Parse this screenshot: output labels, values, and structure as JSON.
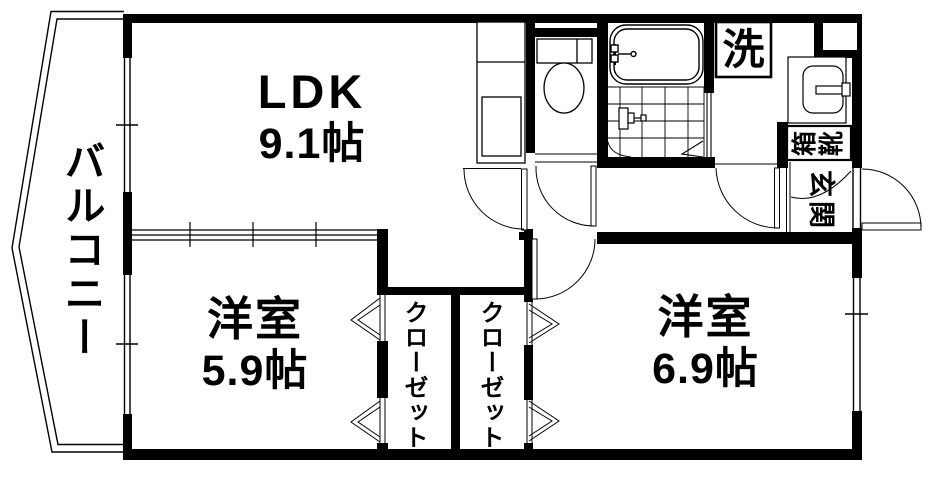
{
  "rooms": {
    "balcony": {
      "label": "バルコニー"
    },
    "ldk": {
      "label": "LDK",
      "size": "9.1帖"
    },
    "western_room_small": {
      "label": "洋室",
      "size": "5.9帖"
    },
    "western_room_large": {
      "label": "洋室",
      "size": "6.9帖"
    },
    "closet_left": {
      "label": "クローゼット"
    },
    "closet_right": {
      "label": "クローゼット"
    },
    "laundry": {
      "label": "洗"
    },
    "shoe_box": {
      "label": "靴箱",
      "char_left": "箱",
      "char_right": "靴"
    },
    "entrance": {
      "label": "玄関",
      "char1": "玄",
      "char2": "関"
    }
  },
  "colors": {
    "wall": "#000000",
    "background": "#ffffff",
    "line": "#000000"
  }
}
